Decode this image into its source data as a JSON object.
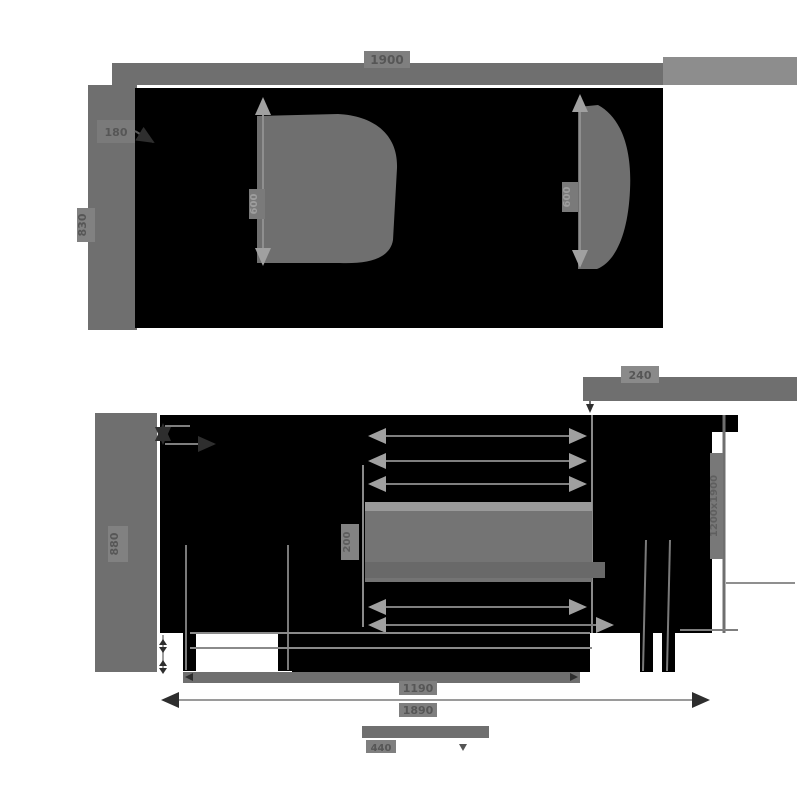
{
  "colors": {
    "background": "#ffffff",
    "silhouette": "#000000",
    "dimension_gray": "#6f6f6f",
    "halo_gray": "#7f7f7f",
    "light_gray": "#9a9a9a",
    "label_dark": "#565656",
    "label_light": "#9e9e9e"
  },
  "front_view": {
    "width_label": "1900",
    "height_label": "830",
    "callout_label": "180",
    "left_inner_height_label": "600",
    "right_inner_height_label": "600"
  },
  "side_view": {
    "height_label": "880",
    "top_right_width_label": "240",
    "mattress_thickness_label": "200",
    "mattress_size_label": "1200x1900",
    "inner_depth_label": "1190",
    "overall_depth_label": "1890",
    "seat_depth_label": "440"
  }
}
